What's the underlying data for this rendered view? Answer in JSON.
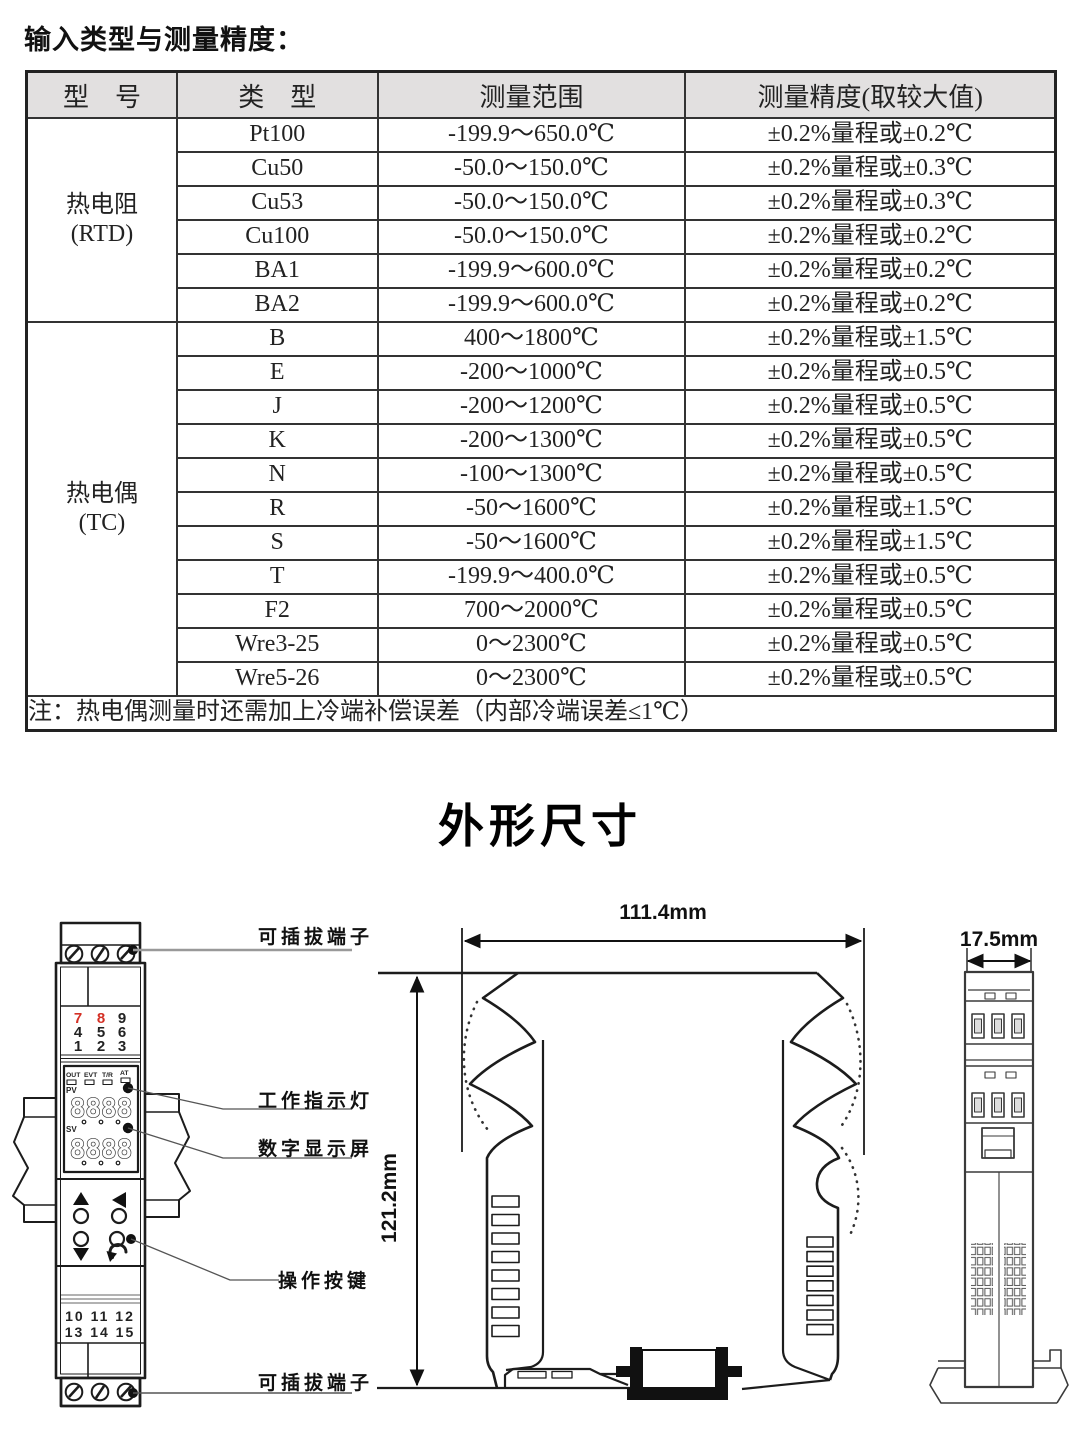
{
  "page": {
    "title": "输入类型与测量精度："
  },
  "table": {
    "headers": [
      "型　号",
      "类　型",
      "测量范围",
      "测量精度(取较大值)"
    ],
    "groups": [
      {
        "model": "热电阻",
        "model_sub": "(RTD)",
        "rows": [
          {
            "type": "Pt100",
            "range": "-199.9～650.0℃",
            "accuracy": "±0.2%量程或±0.2℃"
          },
          {
            "type": "Cu50",
            "range": "-50.0～150.0℃",
            "accuracy": "±0.2%量程或±0.3℃"
          },
          {
            "type": "Cu53",
            "range": "-50.0～150.0℃",
            "accuracy": "±0.2%量程或±0.3℃"
          },
          {
            "type": "Cu100",
            "range": "-50.0～150.0℃",
            "accuracy": "±0.2%量程或±0.2℃"
          },
          {
            "type": "BA1",
            "range": "-199.9～600.0℃",
            "accuracy": "±0.2%量程或±0.2℃"
          },
          {
            "type": "BA2",
            "range": "-199.9～600.0℃",
            "accuracy": "±0.2%量程或±0.2℃"
          }
        ]
      },
      {
        "model": "热电偶",
        "model_sub": "(TC)",
        "rows": [
          {
            "type": "B",
            "range": "400～1800℃",
            "accuracy": "±0.2%量程或±1.5℃"
          },
          {
            "type": "E",
            "range": "-200～1000℃",
            "accuracy": "±0.2%量程或±0.5℃"
          },
          {
            "type": "J",
            "range": "-200～1200℃",
            "accuracy": "±0.2%量程或±0.5℃"
          },
          {
            "type": "K",
            "range": "-200～1300℃",
            "accuracy": "±0.2%量程或±0.5℃"
          },
          {
            "type": "N",
            "range": "-100～1300℃",
            "accuracy": "±0.2%量程或±0.5℃"
          },
          {
            "type": "R",
            "range": "-50～1600℃",
            "accuracy": "±0.2%量程或±1.5℃"
          },
          {
            "type": "S",
            "range": "-50～1600℃",
            "accuracy": "±0.2%量程或±1.5℃"
          },
          {
            "type": "T",
            "range": "-199.9～400.0℃",
            "accuracy": "±0.2%量程或±0.5℃"
          },
          {
            "type": "F2",
            "range": "700～2000℃",
            "accuracy": "±0.2%量程或±0.5℃"
          },
          {
            "type": "Wre3-25",
            "range": "0～2300℃",
            "accuracy": "±0.2%量程或±0.5℃"
          },
          {
            "type": "Wre5-26",
            "range": "0～2300℃",
            "accuracy": "±0.2%量程或±0.5℃"
          }
        ]
      }
    ],
    "note": "注：热电偶测量时还需加上冷端补偿误差（内部冷端误差≤1℃）"
  },
  "dimensions": {
    "section_title": "外形尺寸",
    "front_view": {
      "labels": {
        "top_terminal": "可插拔端子",
        "indicator": "工作指示灯",
        "display": "数字显示屏",
        "buttons": "操作按键",
        "bottom_terminal": "可插拔端子"
      },
      "keypad": [
        [
          "7",
          "8",
          "9"
        ],
        [
          "4",
          "5",
          "6"
        ],
        [
          "1",
          "2",
          "3"
        ]
      ],
      "indicators": [
        "OUT",
        "EVT",
        "T/R",
        "AT"
      ],
      "pv_label": "PV",
      "sv_label": "SV",
      "pv_display": "8888",
      "sv_display": "8888",
      "terminal_row_top": "10 11 12",
      "terminal_row_bottom": "13 14 15",
      "red_color": "#d43025"
    },
    "side_view": {
      "width": "111.4mm",
      "height": "121.2mm"
    },
    "end_view": {
      "width": "17.5mm"
    }
  }
}
